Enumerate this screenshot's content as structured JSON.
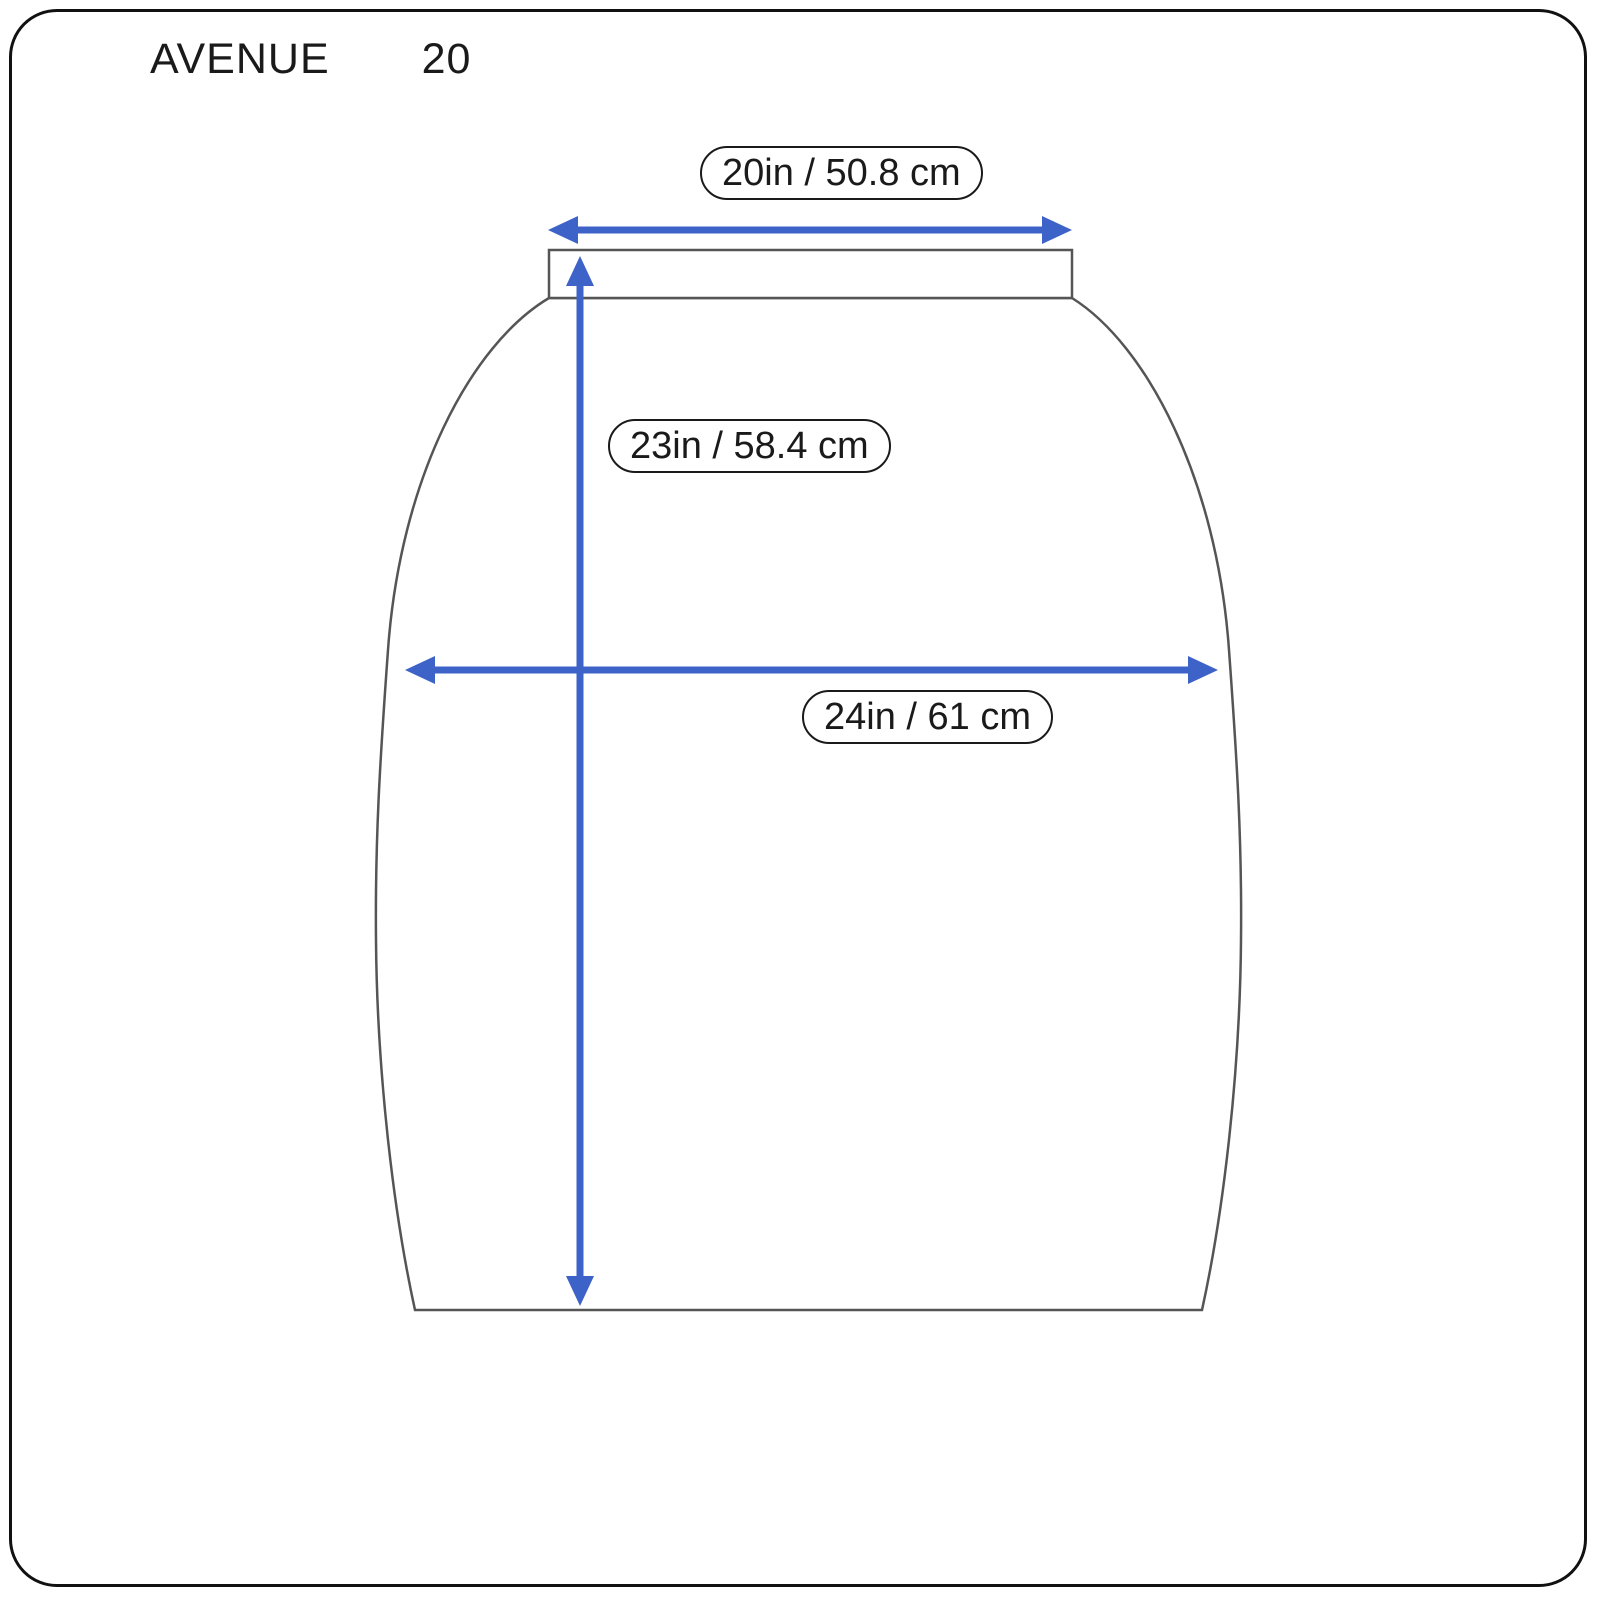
{
  "page": {
    "brand": "AVENUE",
    "size_number": "20"
  },
  "diagram": {
    "type": "garment-size-diagram",
    "garment": "skirt",
    "measurements": [
      {
        "id": "waist-width",
        "label": "20in / 50.8 cm",
        "orientation": "horizontal",
        "position": "top"
      },
      {
        "id": "length",
        "label": "23in / 58.4 cm",
        "orientation": "vertical",
        "position": "middle"
      },
      {
        "id": "hip-width",
        "label": "24in / 61 cm",
        "orientation": "horizontal",
        "position": "middle"
      }
    ],
    "colors": {
      "arrow": "#3E63C8",
      "outline": "#555555",
      "border": "#111111",
      "background": "#ffffff",
      "text": "#1a1a1a"
    }
  }
}
